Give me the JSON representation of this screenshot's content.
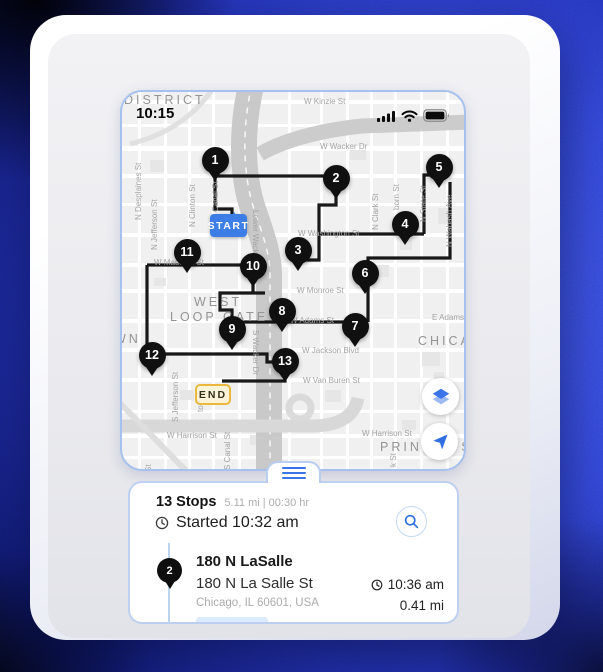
{
  "status_bar": {
    "time": "10:15",
    "icons": [
      "signal-icon",
      "wifi-icon",
      "battery-icon"
    ]
  },
  "map": {
    "start_label": "START",
    "end_label": "END",
    "start_badge": {
      "x": 88,
      "y": 122,
      "w": 37,
      "h": 23
    },
    "end_badge": {
      "x": 73,
      "y": 292,
      "w": 36,
      "h": 21
    },
    "stops": [
      {
        "n": "1",
        "x": 93,
        "y": 68
      },
      {
        "n": "2",
        "x": 214,
        "y": 86
      },
      {
        "n": "3",
        "x": 176,
        "y": 158
      },
      {
        "n": "4",
        "x": 283,
        "y": 132
      },
      {
        "n": "5",
        "x": 317,
        "y": 75
      },
      {
        "n": "6",
        "x": 243,
        "y": 181
      },
      {
        "n": "7",
        "x": 233,
        "y": 234
      },
      {
        "n": "8",
        "x": 160,
        "y": 219
      },
      {
        "n": "9",
        "x": 110,
        "y": 237
      },
      {
        "n": "10",
        "x": 131,
        "y": 174
      },
      {
        "n": "11",
        "x": 65,
        "y": 160
      },
      {
        "n": "12",
        "x": 30,
        "y": 263
      },
      {
        "n": "13",
        "x": 163,
        "y": 269
      }
    ],
    "route": [
      [
        [
          93,
          85
        ],
        [
          93,
          117
        ],
        [
          110,
          117
        ],
        [
          110,
          124
        ]
      ],
      [
        [
          93,
          84
        ],
        [
          214,
          84
        ]
      ],
      [
        [
          214,
          100
        ],
        [
          214,
          113
        ],
        [
          197,
          113
        ],
        [
          197,
          168
        ],
        [
          180,
          168
        ]
      ],
      [
        [
          197,
          142
        ],
        [
          302,
          142
        ]
      ],
      [
        [
          302,
          142
        ],
        [
          302,
          83
        ],
        [
          316,
          83
        ]
      ],
      [
        [
          328,
          90
        ],
        [
          328,
          166
        ],
        [
          246,
          166
        ],
        [
          246,
          230
        ]
      ],
      [
        [
          246,
          230
        ],
        [
          110,
          230
        ],
        [
          110,
          236
        ]
      ],
      [
        [
          110,
          230
        ],
        [
          110,
          218
        ],
        [
          98,
          218
        ],
        [
          98,
          201
        ],
        [
          143,
          201
        ]
      ],
      [
        [
          131,
          190
        ],
        [
          131,
          201
        ]
      ],
      [
        [
          25,
          173
        ],
        [
          133,
          173
        ]
      ],
      [
        [
          25,
          173
        ],
        [
          25,
          263
        ]
      ],
      [
        [
          36,
          262
        ],
        [
          145,
          262
        ],
        [
          145,
          270
        ],
        [
          157,
          270
        ]
      ],
      [
        [
          163,
          283
        ],
        [
          163,
          289
        ],
        [
          100,
          289
        ]
      ]
    ],
    "street_labels": [
      {
        "t": "W Kinzie St",
        "x": 182,
        "y": 5,
        "r": 0
      },
      {
        "t": "W Wacker Dr",
        "x": 198,
        "y": 50,
        "r": 0
      },
      {
        "t": "W Washington St",
        "x": 176,
        "y": 137,
        "r": 0
      },
      {
        "t": "W Madison St",
        "x": 32,
        "y": 166,
        "r": 0
      },
      {
        "t": "W Monroe St",
        "x": 175,
        "y": 194,
        "r": 0
      },
      {
        "t": "W Adams St",
        "x": 168,
        "y": 224,
        "r": 0
      },
      {
        "t": "E Adams",
        "x": 310,
        "y": 221,
        "r": 0
      },
      {
        "t": "W Jackson Blvd",
        "x": 180,
        "y": 254,
        "r": 0
      },
      {
        "t": "W Van Buren St",
        "x": 181,
        "y": 284,
        "r": 0
      },
      {
        "t": "W Harrison St",
        "x": 45,
        "y": 339,
        "r": 0
      },
      {
        "t": "W Harrison St",
        "x": 240,
        "y": 337,
        "r": 0
      },
      {
        "t": "N Desplaines St",
        "x": 12,
        "y": 128,
        "r": -90
      },
      {
        "t": "N Jefferson St",
        "x": 28,
        "y": 158,
        "r": -90
      },
      {
        "t": "N Clinton St",
        "x": 66,
        "y": 135,
        "r": -90
      },
      {
        "t": "N Canal St",
        "x": 89,
        "y": 128,
        "r": -90
      },
      {
        "t": "Lower Wacker Dr",
        "x": 138,
        "y": 118,
        "r": 90
      },
      {
        "t": "N Clark St",
        "x": 249,
        "y": 138,
        "r": -90
      },
      {
        "t": "born St",
        "x": 270,
        "y": 118,
        "r": -90
      },
      {
        "t": "N State St",
        "x": 297,
        "y": 130,
        "r": -90
      },
      {
        "t": "N Wabash Ave",
        "x": 323,
        "y": 155,
        "r": -90
      },
      {
        "t": "S Jefferson St",
        "x": 49,
        "y": 330,
        "r": -90
      },
      {
        "t": "ton St",
        "x": 74,
        "y": 320,
        "r": -90
      },
      {
        "t": "S Canal St",
        "x": 101,
        "y": 378,
        "r": -90
      },
      {
        "t": "S Wacker Dr",
        "x": 138,
        "y": 238,
        "r": 90
      },
      {
        "t": "k St",
        "x": 267,
        "y": 375,
        "r": -90
      },
      {
        "t": "St",
        "x": 22,
        "y": 380,
        "r": -90
      }
    ],
    "area_labels": [
      {
        "t": "DISTRICT",
        "x": 2,
        "y": 1
      },
      {
        "t": "WEST",
        "x": 72,
        "y": 203
      },
      {
        "t": "LOOP GATE",
        "x": 48,
        "y": 218
      },
      {
        "t": "CHICAGO",
        "x": 296,
        "y": 242
      },
      {
        "t": "WN",
        "x": -8,
        "y": 240
      },
      {
        "t": "PRINTER'S R",
        "x": 258,
        "y": 348
      }
    ],
    "controls": [
      "layers-icon",
      "navigation-icon"
    ]
  },
  "sheet": {
    "stops_title": "13 Stops",
    "summary": "5.11 mi | 00:30 hr",
    "started": "Started 10:32 am",
    "stop": {
      "number": "2",
      "name": "180 N LaSalle",
      "address": "180 N La Salle St",
      "city": "Chicago, IL 60601, USA",
      "eta": "10:36 am",
      "distance": "0.41 mi"
    }
  },
  "colors": {
    "accent": "#2f6fe0",
    "route": "#181818",
    "pin": "#101010",
    "start_bg": "#3d7ee6",
    "end_bg": "#faf3d7",
    "end_border": "#eab83e",
    "map_border": "#a6c1ee",
    "sheet_border": "#bdd0f2",
    "river": "#cbcbcb",
    "timeline": "#bdd4f0",
    "chip_bg": "#d9ebfc"
  }
}
